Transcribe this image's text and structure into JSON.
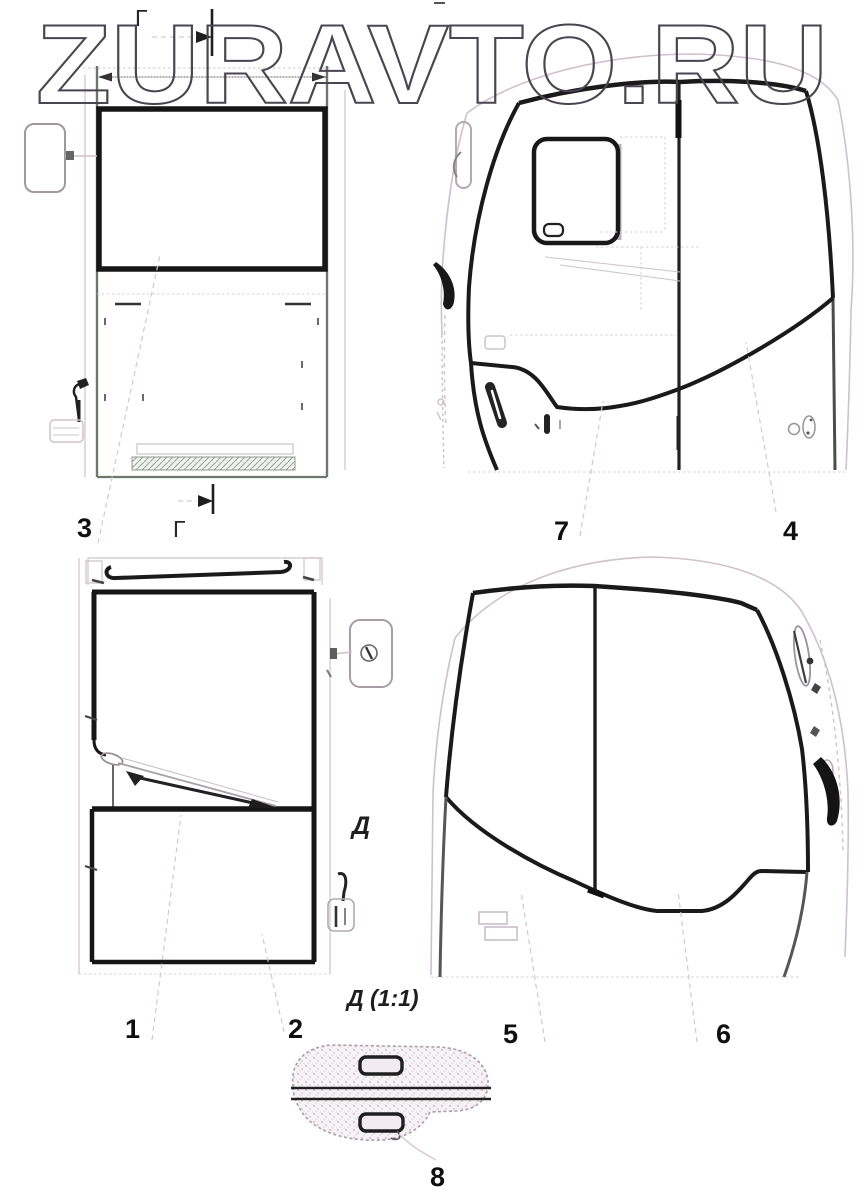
{
  "watermark": {
    "text": "ZURAVTO.RU"
  },
  "labels": {
    "section_g_top": "Г",
    "section_g_bottom": "Г",
    "section_d": "Д",
    "detail_title": "Д (1:1)"
  },
  "callouts": {
    "c1": "1",
    "c2": "2",
    "c3": "3",
    "c4": "4",
    "c5": "5",
    "c6": "6",
    "c7": "7",
    "c8": "8"
  },
  "colors": {
    "background": "#ffffff",
    "line_dark": "#1a1a1a",
    "line_medium": "#6d786d",
    "line_light": "#cfc0cd",
    "watermark_outline": "#4a4550"
  }
}
